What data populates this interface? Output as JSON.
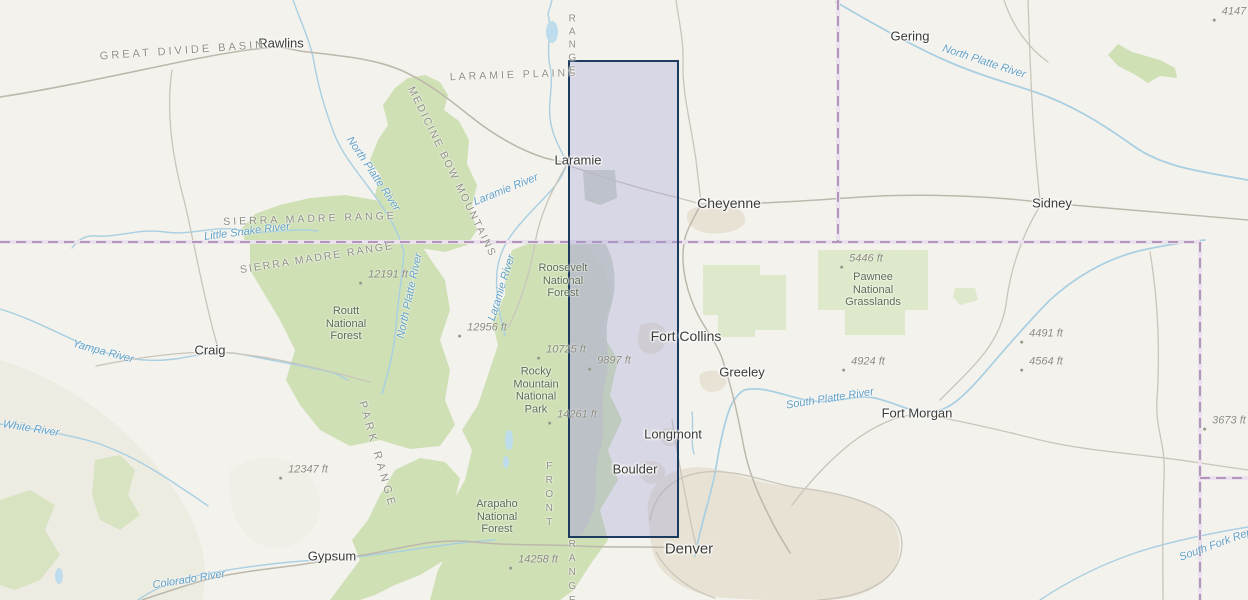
{
  "map": {
    "colors": {
      "land": "#f4f3ee",
      "forest": "#cfe0b5",
      "forest_light": "#dde9ca",
      "gray_sage": "#c6cfc2",
      "water": "#a9cfe2",
      "water_fill": "#bddcec",
      "road": "#c9c5ba",
      "road_major": "#bdb8ac",
      "urban": "#e7e2d4",
      "state_border": "#b394ba",
      "sel_fill": "rgba(160,160,212,0.33)",
      "sel_stroke": "#1d3b5f",
      "city_text": "#3b3b38",
      "region_text": "#8f8e85",
      "forest_text": "#5d6b54",
      "river_text": "#63a0c6",
      "elevation_text": "#8b8b80"
    },
    "selection": {
      "x": 568,
      "y": 60,
      "w": 111,
      "h": 478
    },
    "labels": {
      "cities": [
        {
          "text": "Rawlins",
          "x": 281,
          "y": 44,
          "size": 13
        },
        {
          "text": "Laramie",
          "x": 578,
          "y": 161,
          "size": 13
        },
        {
          "text": "Cheyenne",
          "x": 729,
          "y": 203,
          "size": 14
        },
        {
          "text": "Gering",
          "x": 910,
          "y": 37,
          "size": 13
        },
        {
          "text": "Sidney",
          "x": 1052,
          "y": 204,
          "size": 13
        },
        {
          "text": "Craig",
          "x": 210,
          "y": 351,
          "size": 13
        },
        {
          "text": "Fort Collins",
          "x": 686,
          "y": 336,
          "size": 14
        },
        {
          "text": "Greeley",
          "x": 742,
          "y": 373,
          "size": 13
        },
        {
          "text": "Longmont",
          "x": 673,
          "y": 435,
          "size": 13
        },
        {
          "text": "Boulder",
          "x": 635,
          "y": 470,
          "size": 13
        },
        {
          "text": "Denver",
          "x": 689,
          "y": 549,
          "size": 15
        },
        {
          "text": "Gypsum",
          "x": 332,
          "y": 557,
          "size": 13
        },
        {
          "text": "Fort Morgan",
          "x": 917,
          "y": 414,
          "size": 13
        }
      ],
      "regions": [
        {
          "text": "GREAT DIVIDE BASIN",
          "x": 183,
          "y": 51,
          "rot": -4,
          "ls": 3,
          "size": 11
        },
        {
          "text": "LARAMIE PLAINS",
          "x": 514,
          "y": 75,
          "rot": -2,
          "ls": 3,
          "size": 10.5
        },
        {
          "text": "RANGE",
          "x": 572,
          "y": 46,
          "vert": true,
          "ls": 2,
          "size": 10
        },
        {
          "text": "SIERRA MADRE RANGE",
          "x": 310,
          "y": 219,
          "rot": -2,
          "ls": 3,
          "size": 10.5
        },
        {
          "text": "SIERRA MADRE RANGE",
          "x": 317,
          "y": 258,
          "rot": -9,
          "ls": 2,
          "size": 10.5
        },
        {
          "text": "MEDICINE BOW MOUNTAINS",
          "x": 452,
          "y": 172,
          "rot": 64,
          "ls": 2,
          "size": 10.5
        },
        {
          "text": "PARK RANGE",
          "x": 377,
          "y": 455,
          "rot": 74,
          "ls": 4,
          "size": 11
        },
        {
          "text": "FRONT",
          "x": 549,
          "y": 496,
          "vert": true,
          "ls": 3,
          "size": 10
        },
        {
          "text": "RANGE",
          "x": 572,
          "y": 574,
          "vert": true,
          "ls": 3,
          "size": 10
        }
      ],
      "forests": [
        {
          "text": "Roosevelt\nNational\nForest",
          "x": 563,
          "y": 281
        },
        {
          "text": "Routt\nNational\nForest",
          "x": 346,
          "y": 324
        },
        {
          "text": "Rocky\nMountain\nNational\nPark",
          "x": 536,
          "y": 391
        },
        {
          "text": "Arapaho\nNational\nForest",
          "x": 497,
          "y": 517
        },
        {
          "text": "Pawnee\nNational\nGrasslands",
          "x": 873,
          "y": 290
        }
      ],
      "rivers": [
        {
          "text": "North Platte River",
          "x": 984,
          "y": 62,
          "rot": 18
        },
        {
          "text": "North Platte River",
          "x": 373,
          "y": 174,
          "rot": 56
        },
        {
          "text": "North Platte River",
          "x": 410,
          "y": 296,
          "rot": -78
        },
        {
          "text": "Little Snake River",
          "x": 247,
          "y": 232,
          "rot": -7
        },
        {
          "text": "Laramie River",
          "x": 506,
          "y": 190,
          "rot": -22
        },
        {
          "text": "Laramie River",
          "x": 502,
          "y": 288,
          "rot": -73
        },
        {
          "text": "Yampa River",
          "x": 103,
          "y": 352,
          "rot": 15
        },
        {
          "text": "White River",
          "x": 31,
          "y": 429,
          "rot": 9
        },
        {
          "text": "Colorado River",
          "x": 189,
          "y": 580,
          "rot": -9
        },
        {
          "text": "South Platte River",
          "x": 830,
          "y": 399,
          "rot": -9
        },
        {
          "text": "South Fork Rep",
          "x": 1216,
          "y": 545,
          "rot": -20
        }
      ],
      "elevations": [
        {
          "text": "12191 ft",
          "x": 388,
          "y": 275
        },
        {
          "text": "12956 ft",
          "x": 487,
          "y": 328
        },
        {
          "text": "10725 ft",
          "x": 566,
          "y": 350
        },
        {
          "text": "9897 ft",
          "x": 614,
          "y": 361
        },
        {
          "text": "14261 ft",
          "x": 577,
          "y": 415
        },
        {
          "text": "12347 ft",
          "x": 308,
          "y": 470
        },
        {
          "text": "14258 ft",
          "x": 538,
          "y": 560
        },
        {
          "text": "5446 ft",
          "x": 866,
          "y": 259
        },
        {
          "text": "4924 ft",
          "x": 868,
          "y": 362
        },
        {
          "text": "4491 ft",
          "x": 1046,
          "y": 334
        },
        {
          "text": "4564 ft",
          "x": 1046,
          "y": 362
        },
        {
          "text": "3673 ft",
          "x": 1229,
          "y": 421
        },
        {
          "text": "4147",
          "x": 1234,
          "y": 12
        }
      ]
    }
  }
}
